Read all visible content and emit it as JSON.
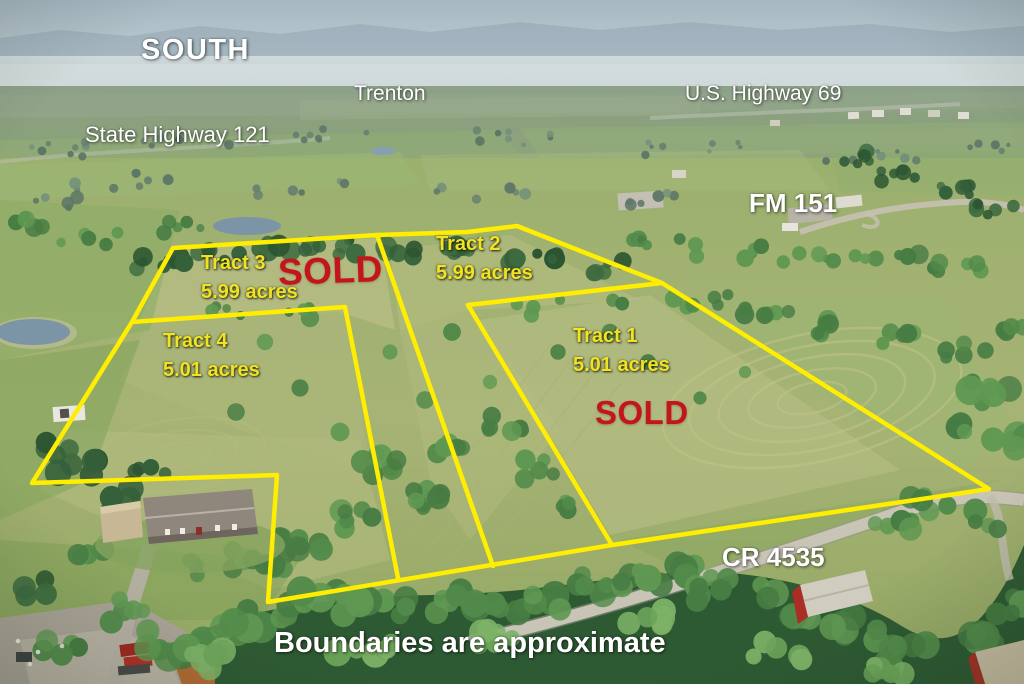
{
  "overlay": {
    "direction": "SOUTH",
    "town": "Trenton",
    "roads": {
      "us_highway": "U.S. Highway 69",
      "state_highway": "State Highway 121",
      "fm_road": "FM 151",
      "county_road": "CR 4535"
    },
    "tracts": [
      {
        "name": "Tract 1",
        "acreage": "5.01 acres",
        "sold": true
      },
      {
        "name": "Tract 2",
        "acreage": "5.99 acres",
        "sold": false
      },
      {
        "name": "Tract 3",
        "acreage": "5.99 acres",
        "sold": true
      },
      {
        "name": "Tract 4",
        "acreage": "5.01 acres",
        "sold": false
      }
    ],
    "sold_label": "SOLD",
    "disclaimer": "Boundaries are approximate",
    "colors": {
      "boundary_line": "#ffee00",
      "tract_label": "#f0e322",
      "sold_text": "#c3161c",
      "place_label": "#ffffff"
    }
  }
}
